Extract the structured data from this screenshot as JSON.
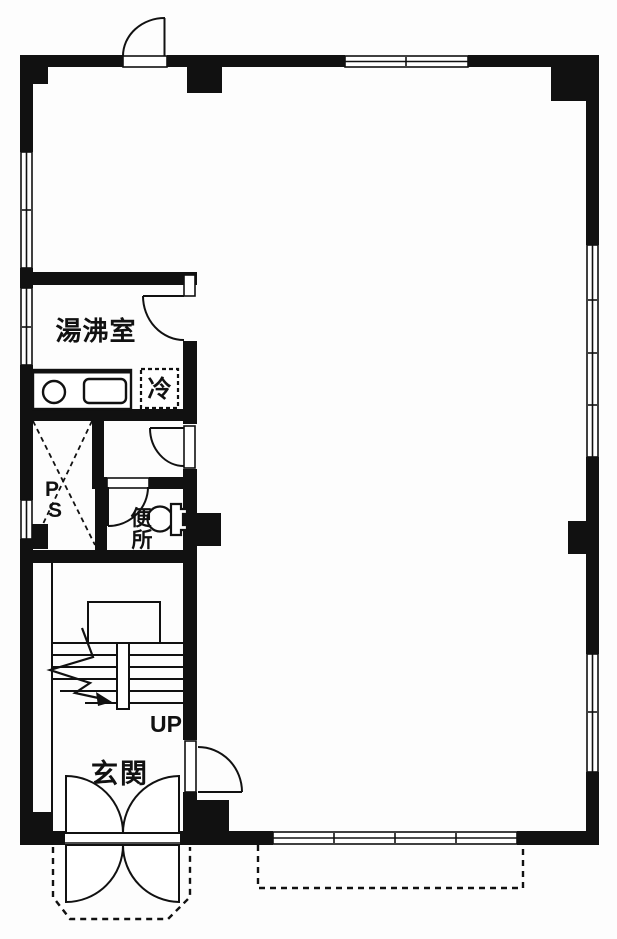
{
  "colors": {
    "ink": "#111111",
    "paper": "#ffffff"
  },
  "labels": {
    "kitchenette": "湯沸室",
    "refrigerator": "冷",
    "pipe_space_chars": [
      "P",
      "S"
    ],
    "toilet_chars": [
      "便",
      "所"
    ],
    "stairs_up": "UP",
    "entrance": "玄関"
  }
}
